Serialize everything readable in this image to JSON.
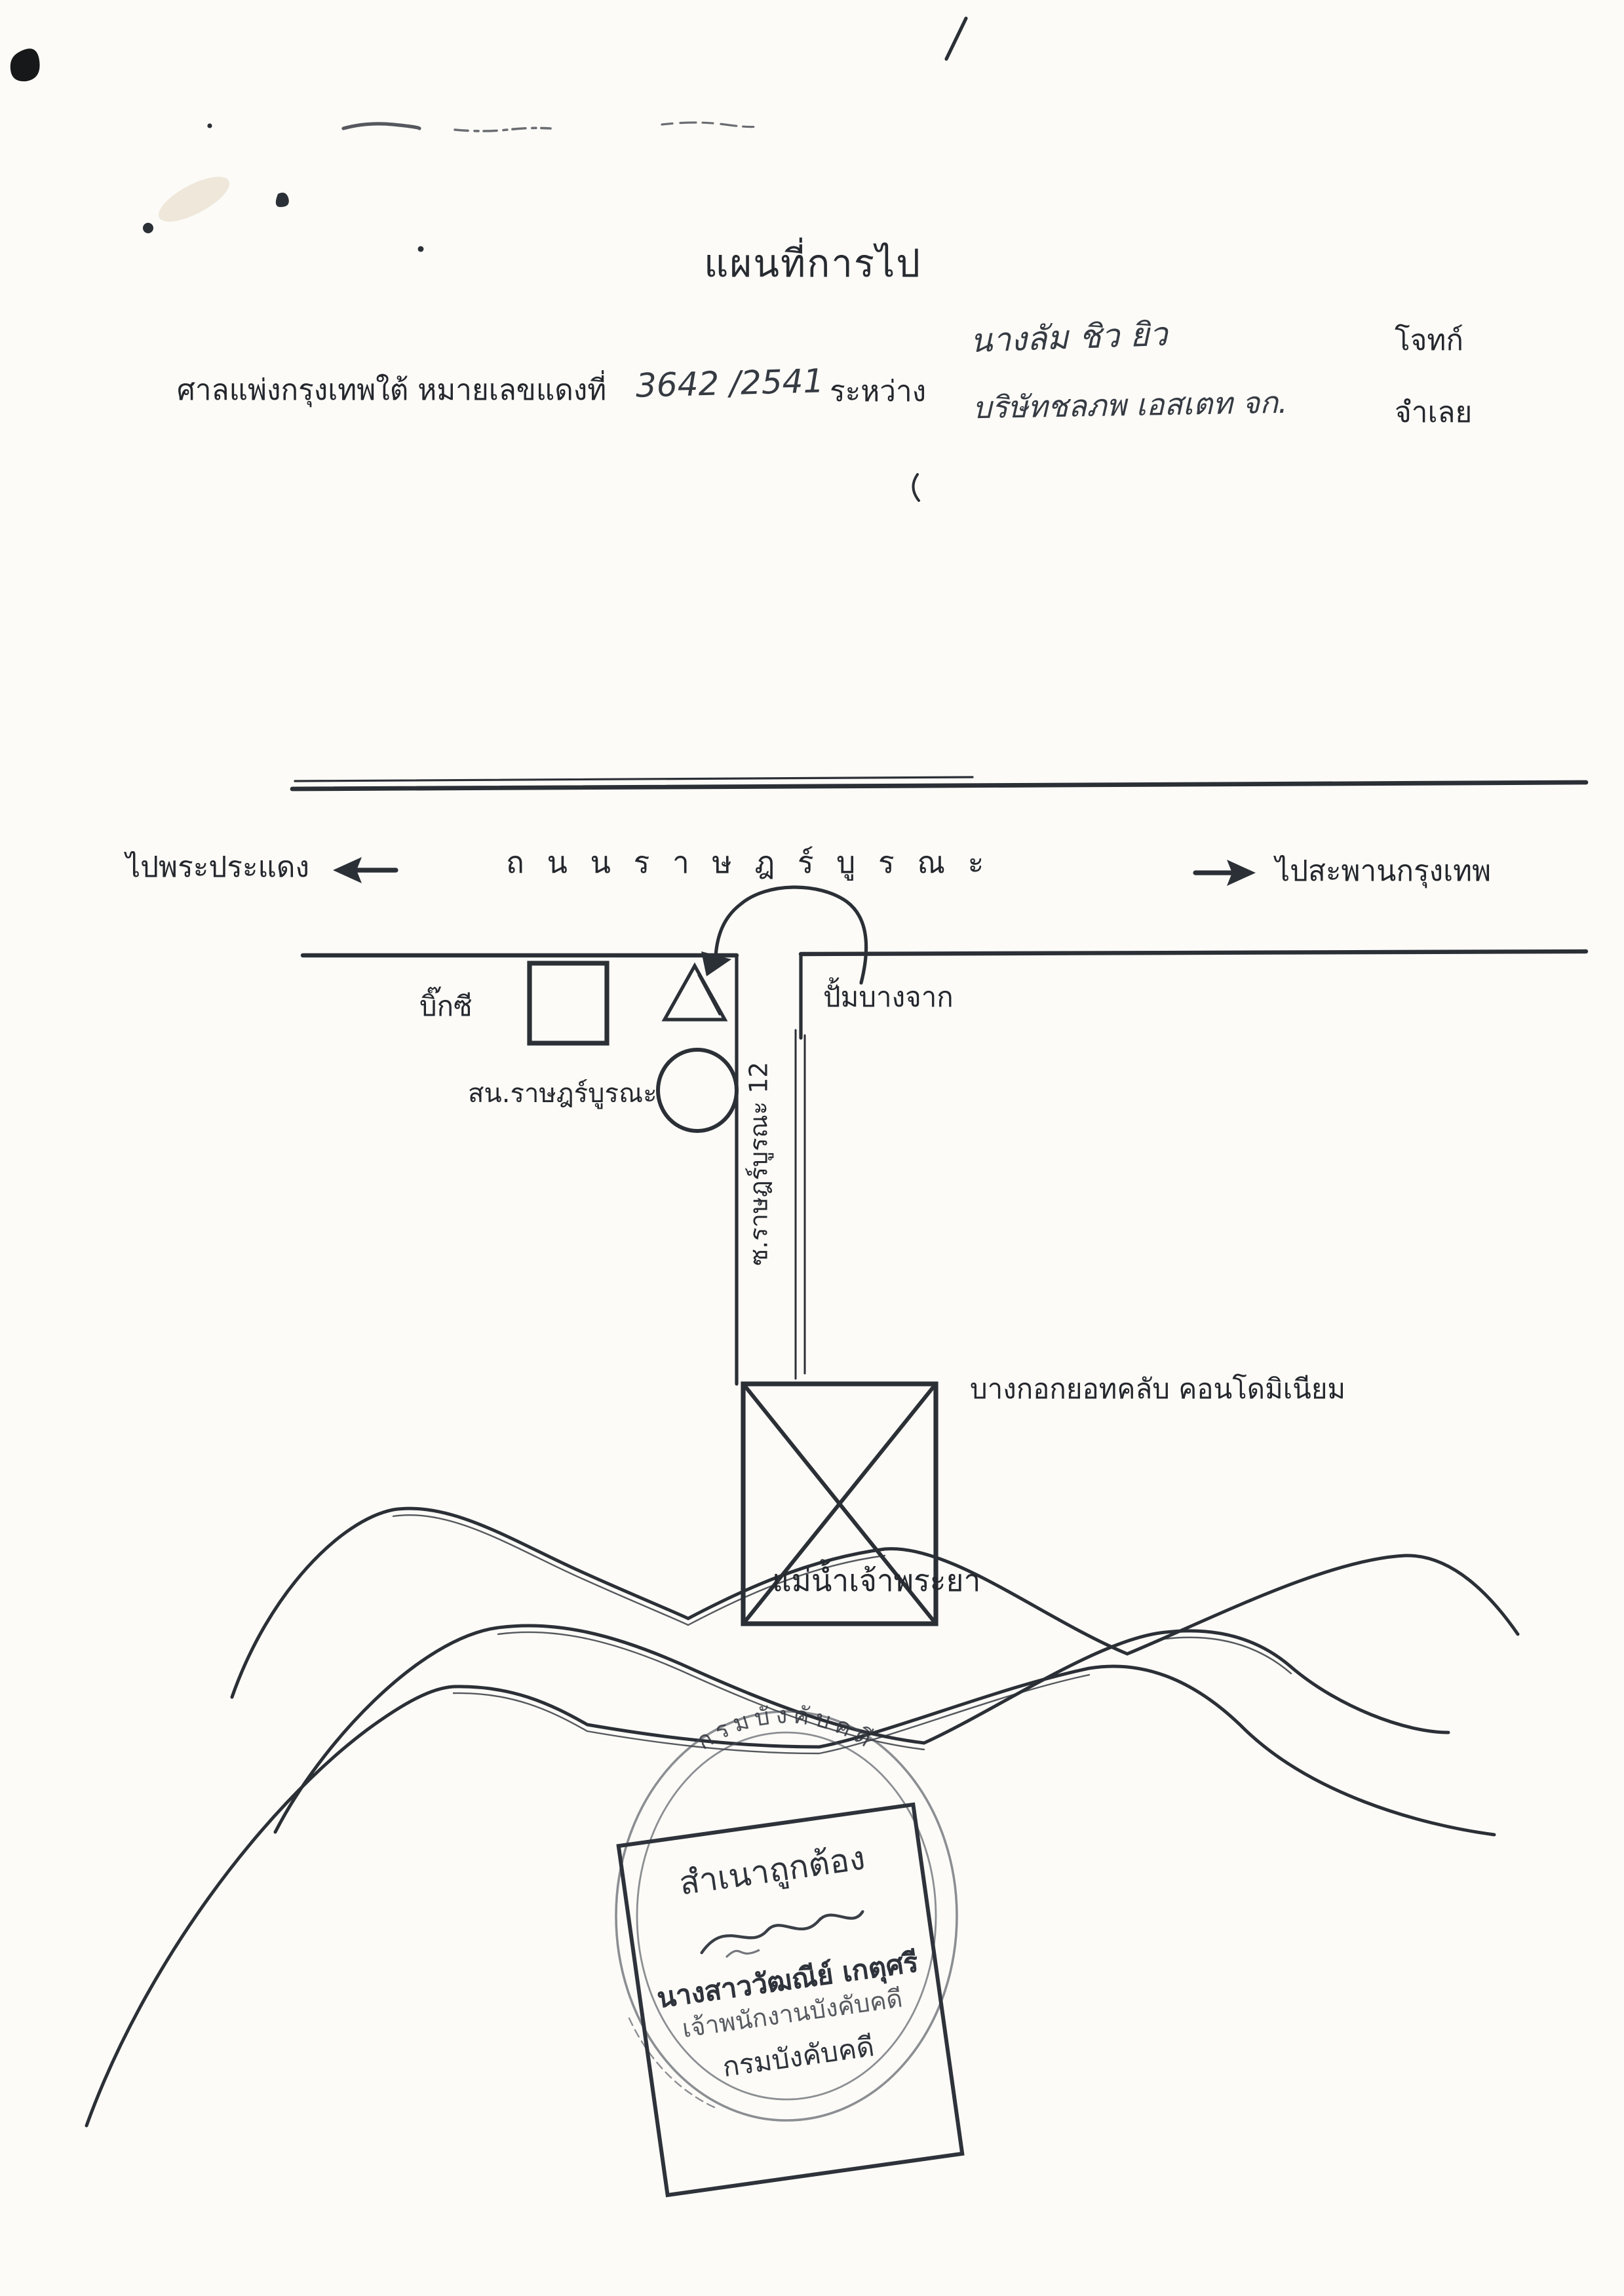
{
  "page": {
    "paper_color": "#fcfbf7",
    "ink_color": "#2b2f36"
  },
  "header": {
    "title": "แผนที่การไป",
    "case_line": {
      "court_prefix": "ศาลแพ่งกรุงเทพใต้ หมายเลขแดงที่",
      "case_number_handwritten": "3642 /2541",
      "between": "ระหว่าง"
    },
    "parties": {
      "plaintiff_name": "นางลัม ชิว ยิว",
      "plaintiff_role": "โจทก์",
      "defendant_name": "บริษัทชลภพ เอสเตท จก.",
      "defendant_role": "จำเลย"
    }
  },
  "map": {
    "road_name": "ถ น น ร า ษ ฎ ร์ บู ร ณ ะ",
    "west_label": "ไปพระประแดง",
    "east_label": "ไปสะพานกรุงเทพ",
    "bigc_label": "บิ๊กซี",
    "police_label": "สน.ราษฎร์บูรณะ",
    "gas_label": "ปั้มบางจาก",
    "soi_label": "ซ.ราษฎร์บูรณะ 12",
    "condo_label": "บางกอกยอทคลับ คอนโดมิเนียม",
    "river_label": "แม่น้ำเจ้าพระยา"
  },
  "stamp": {
    "seal_arc_text": "กรมบังคับคดี",
    "certify_line": "สำเนาถูกต้อง",
    "officer_name": "นางสาววัฒณีย์ เกตุศรี",
    "officer_title": "เจ้าพนักงานบังคับคดี",
    "department": "กรมบังคับคดี"
  }
}
